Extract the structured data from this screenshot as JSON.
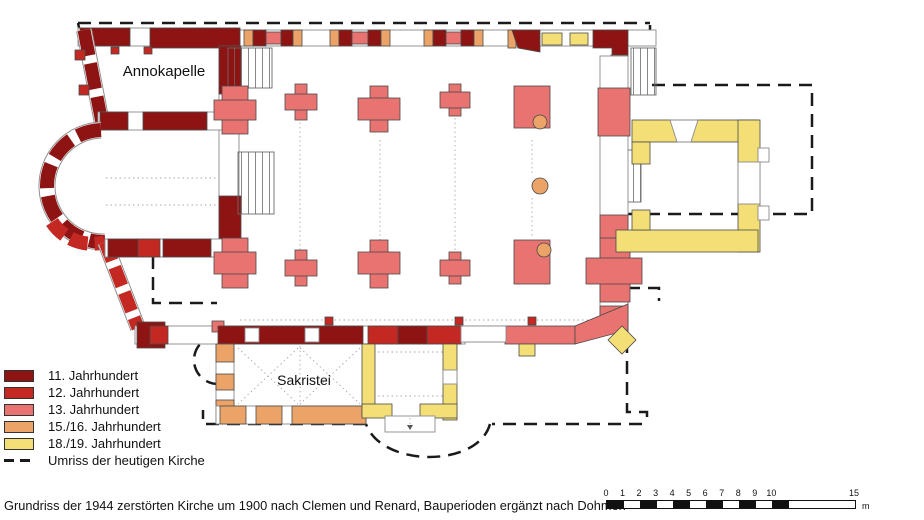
{
  "colors": {
    "c11": "#8e1414",
    "c12": "#c32822",
    "c13": "#e87370",
    "c1516": "#eca368",
    "c1819": "#f3df76",
    "outline": "#1a1a1a"
  },
  "legend": {
    "items": [
      {
        "label": "11. Jahrhundert",
        "color_key": "c11",
        "type": "swatch"
      },
      {
        "label": "12. Jahrhundert",
        "color_key": "c12",
        "type": "swatch"
      },
      {
        "label": "13. Jahrhundert",
        "color_key": "c13",
        "type": "swatch"
      },
      {
        "label": "15./16. Jahrhundert",
        "color_key": "c1516",
        "type": "swatch"
      },
      {
        "label": "18./19. Jahrhundert",
        "color_key": "c1819",
        "type": "swatch"
      },
      {
        "label": "Umriss der heutigen Kirche",
        "color_key": "outline",
        "type": "dash"
      }
    ]
  },
  "rooms": {
    "annokapelle": "Annokapelle",
    "sakristei": "Sakristei"
  },
  "caption": "Grundriss der 1944 zerstörten Kirche um 1900 nach Clemen und Renard, Bauperioden ergänzt nach Dohmen",
  "scale_bar": {
    "ticks": [
      0,
      1,
      2,
      3,
      4,
      5,
      6,
      7,
      8,
      9,
      10,
      15
    ],
    "max": 15,
    "unit": "m",
    "black_segments": [
      [
        0,
        1
      ],
      [
        2,
        3
      ],
      [
        4,
        5
      ],
      [
        6,
        7
      ],
      [
        8,
        9
      ],
      [
        10,
        11
      ]
    ]
  }
}
